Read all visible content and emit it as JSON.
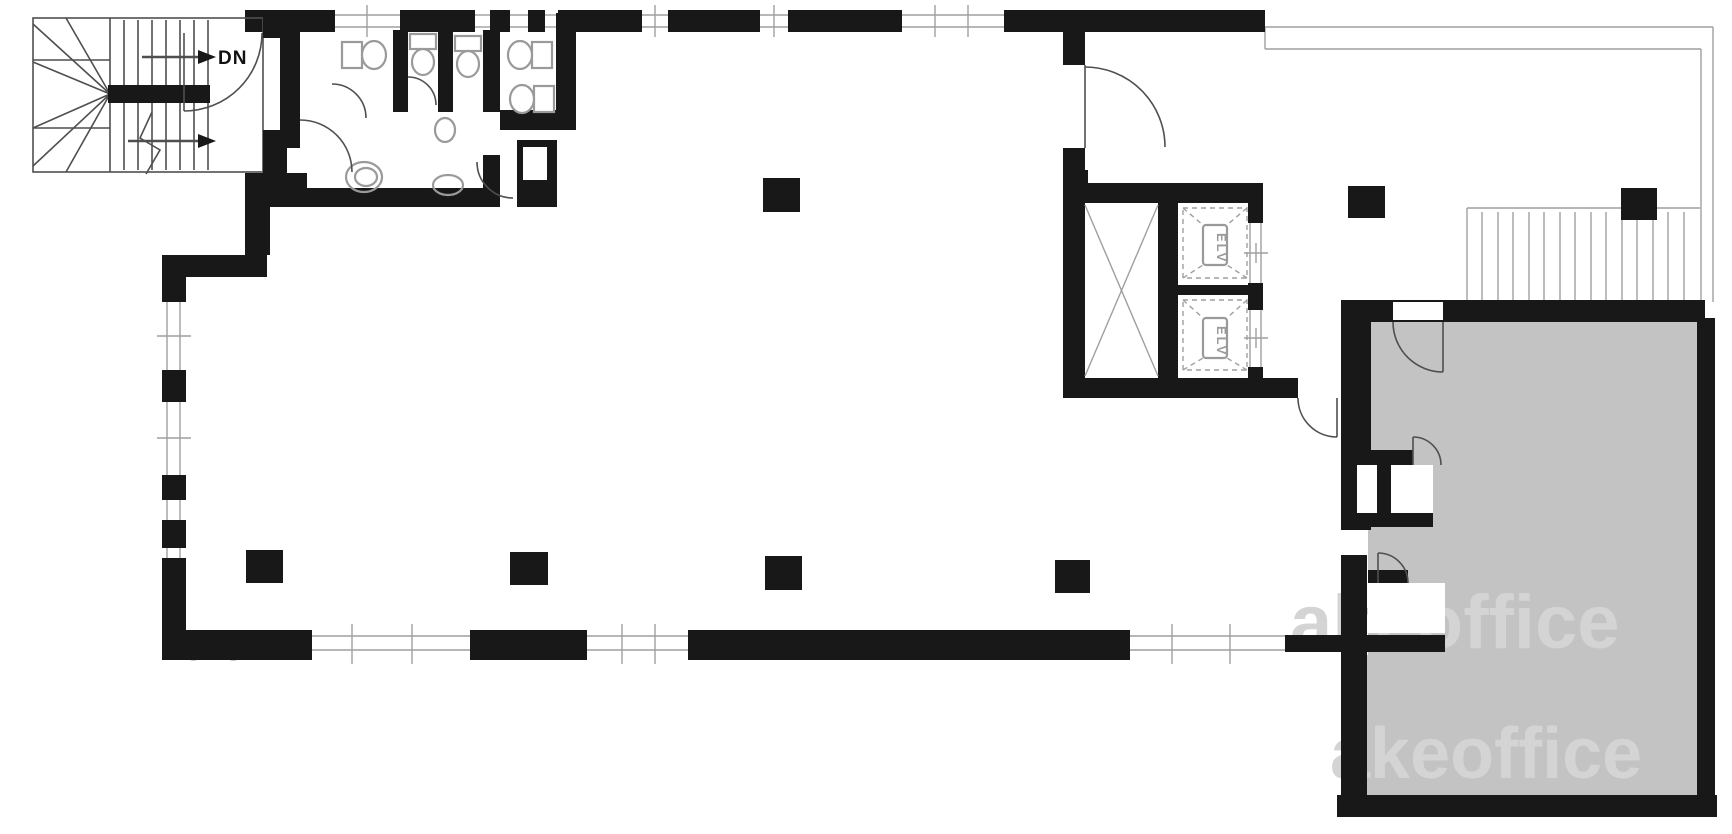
{
  "plan": {
    "type": "architectural-floor-plan",
    "description": "Office building floor plan with stairwell, restrooms, elevator core, open floor area with columns, exterior stair terrace and shaded private room",
    "stairs": {
      "dn_label": "DN"
    },
    "elevators": {
      "cab1_label": "ELV",
      "cab2_label": "ELV"
    },
    "watermarks": {
      "left": "co",
      "middle": "akeoffice",
      "bottom": "akeoffice"
    },
    "colors": {
      "wall": "#181818",
      "line": "#4f4f4f",
      "light_line": "#9f9f9f",
      "room_fill": "#c3c3c3",
      "fixture": "#9a9a9a",
      "watermark": "#d4d4d4",
      "background": "#ffffff"
    },
    "rooms": [
      {
        "name": "stairwell",
        "label": ""
      },
      {
        "name": "restrooms",
        "label": ""
      },
      {
        "name": "elevator-core",
        "label": ""
      },
      {
        "name": "open-floor-area",
        "label": ""
      },
      {
        "name": "shaded-private-room",
        "label": ""
      },
      {
        "name": "terrace-with-exterior-stair",
        "label": ""
      }
    ],
    "features": {
      "columns": 7,
      "elevators": 2,
      "toilets": 5,
      "sinks": 3,
      "stairways": 2,
      "door_swings": 10
    }
  }
}
